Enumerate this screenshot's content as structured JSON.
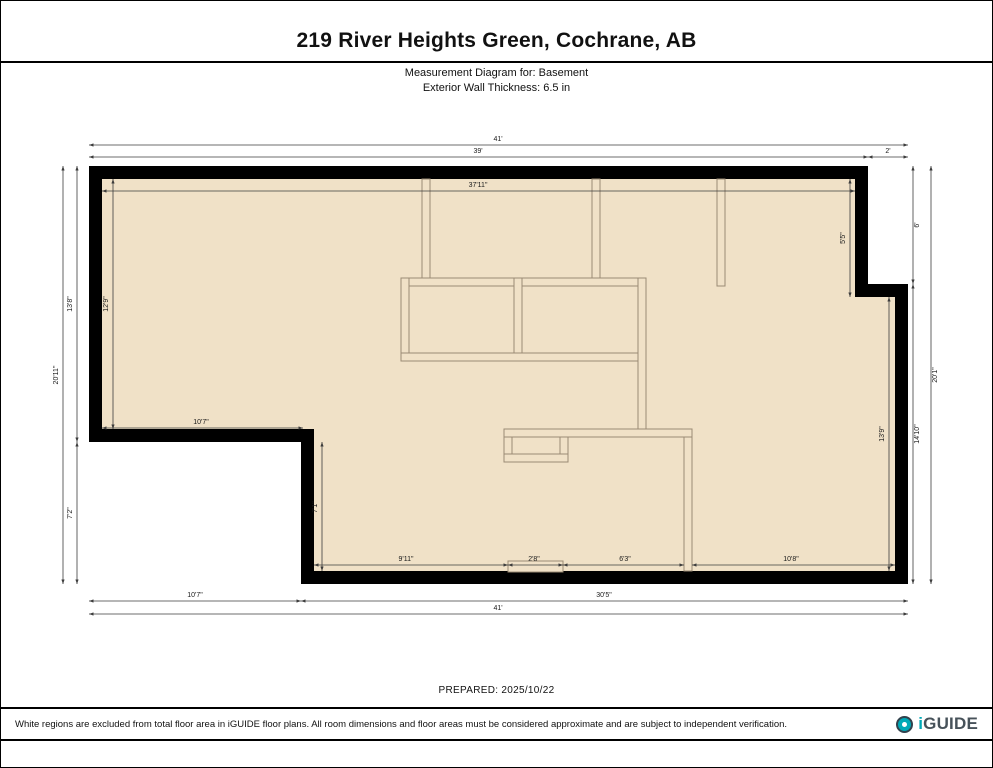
{
  "header": {
    "title": "219 River Heights Green, Cochrane, AB",
    "subtitle1": "Measurement Diagram for: Basement",
    "subtitle2": "Exterior Wall Thickness: 6.5 in"
  },
  "prepared": "PREPARED: 2025/10/22",
  "footer": {
    "disclaimer": "White regions are excluded from total floor area in iGUIDE floor plans. All room dimensions and floor areas must be considered approximate and are subject to independent verification.",
    "brand_i": "i",
    "brand_rest": "GUIDE"
  },
  "floorplan": {
    "colors": {
      "floor": "#f0e1c7",
      "wall": "#000000",
      "wall_line": "#9a8a74",
      "dim": "#3c3c3c",
      "label": "#1a1a1a"
    },
    "exterior_outer": [
      [
        88,
        165
      ],
      [
        867,
        165
      ],
      [
        867,
        283
      ],
      [
        907,
        283
      ],
      [
        907,
        583
      ],
      [
        300,
        583
      ],
      [
        300,
        441
      ],
      [
        88,
        441
      ]
    ],
    "exterior_inner": [
      [
        101,
        178
      ],
      [
        854,
        178
      ],
      [
        854,
        296
      ],
      [
        894,
        296
      ],
      [
        894,
        570
      ],
      [
        313,
        570
      ],
      [
        313,
        428
      ],
      [
        101,
        428
      ]
    ],
    "interior_walls": [
      [
        421,
        178,
        8,
        101
      ],
      [
        591,
        178,
        8,
        101
      ],
      [
        716,
        178,
        8,
        107
      ],
      [
        400,
        277,
        245,
        8
      ],
      [
        400,
        277,
        8,
        83
      ],
      [
        513,
        277,
        8,
        83
      ],
      [
        400,
        352,
        245,
        8
      ],
      [
        637,
        277,
        8,
        156
      ],
      [
        503,
        428,
        188,
        8
      ],
      [
        503,
        436,
        8,
        25
      ],
      [
        559,
        436,
        8,
        25
      ],
      [
        503,
        453,
        64,
        8
      ],
      [
        683,
        436,
        8,
        134
      ],
      [
        507,
        560,
        55,
        11
      ]
    ],
    "dims": [
      {
        "text": "41'",
        "line": [
          88,
          144,
          907,
          144
        ],
        "at": [
          497,
          140
        ],
        "rot": false
      },
      {
        "text": "39'",
        "line": [
          88,
          156,
          867,
          156
        ],
        "at": [
          477,
          152
        ],
        "rot": false
      },
      {
        "text": "2'",
        "line": [
          867,
          156,
          907,
          156
        ],
        "at": [
          887,
          152
        ],
        "rot": false
      },
      {
        "text": "37'11\"",
        "line": [
          101,
          190,
          854,
          190
        ],
        "at": [
          477,
          186
        ],
        "rot": false
      },
      {
        "text": "10'7\"",
        "line": [
          101,
          427,
          302,
          427
        ],
        "at": [
          200,
          423
        ],
        "rot": false
      },
      {
        "text": "9'11\"",
        "line": [
          313,
          564,
          507,
          564
        ],
        "at": [
          405,
          560
        ],
        "rot": false
      },
      {
        "text": "2'8\"",
        "line": [
          507,
          564,
          562,
          564
        ],
        "at": [
          533,
          560
        ],
        "rot": false
      },
      {
        "text": "6'3\"",
        "line": [
          562,
          564,
          683,
          564
        ],
        "at": [
          624,
          560
        ],
        "rot": false
      },
      {
        "text": "10'8\"",
        "line": [
          691,
          564,
          894,
          564
        ],
        "at": [
          790,
          560
        ],
        "rot": false
      },
      {
        "text": "10'7\"",
        "line": [
          88,
          600,
          300,
          600
        ],
        "at": [
          194,
          596
        ],
        "rot": false
      },
      {
        "text": "30'5\"",
        "line": [
          300,
          600,
          907,
          600
        ],
        "at": [
          603,
          596
        ],
        "rot": false
      },
      {
        "text": "41'",
        "line": [
          88,
          613,
          907,
          613
        ],
        "at": [
          497,
          609
        ],
        "rot": false
      },
      {
        "text": "20'11\"",
        "line": [
          62,
          165,
          62,
          583
        ],
        "at": [
          57,
          374
        ],
        "rot": true
      },
      {
        "text": "13'8\"",
        "line": [
          76,
          165,
          76,
          441
        ],
        "at": [
          71,
          303
        ],
        "rot": true
      },
      {
        "text": "7'2\"",
        "line": [
          76,
          441,
          76,
          583
        ],
        "at": [
          71,
          512
        ],
        "rot": true
      },
      {
        "text": "12'9\"",
        "line": [
          112,
          178,
          112,
          428
        ],
        "at": [
          107,
          303
        ],
        "rot": true
      },
      {
        "text": "6'",
        "line": [
          912,
          165,
          912,
          283
        ],
        "at": [
          918,
          224
        ],
        "rot": true
      },
      {
        "text": "14'10\"",
        "line": [
          912,
          283,
          912,
          583
        ],
        "at": [
          918,
          433
        ],
        "rot": true
      },
      {
        "text": "20'1\"",
        "line": [
          930,
          165,
          930,
          583
        ],
        "at": [
          936,
          374
        ],
        "rot": true
      },
      {
        "text": "5'5\"",
        "line": [
          849,
          178,
          849,
          296
        ],
        "at": [
          844,
          237
        ],
        "rot": true
      },
      {
        "text": "13'9\"",
        "line": [
          888,
          296,
          888,
          570
        ],
        "at": [
          883,
          433
        ],
        "rot": true
      },
      {
        "text": "7'1\"",
        "line": [
          321,
          441,
          321,
          570
        ],
        "at": [
          316,
          506
        ],
        "rot": true
      }
    ]
  }
}
